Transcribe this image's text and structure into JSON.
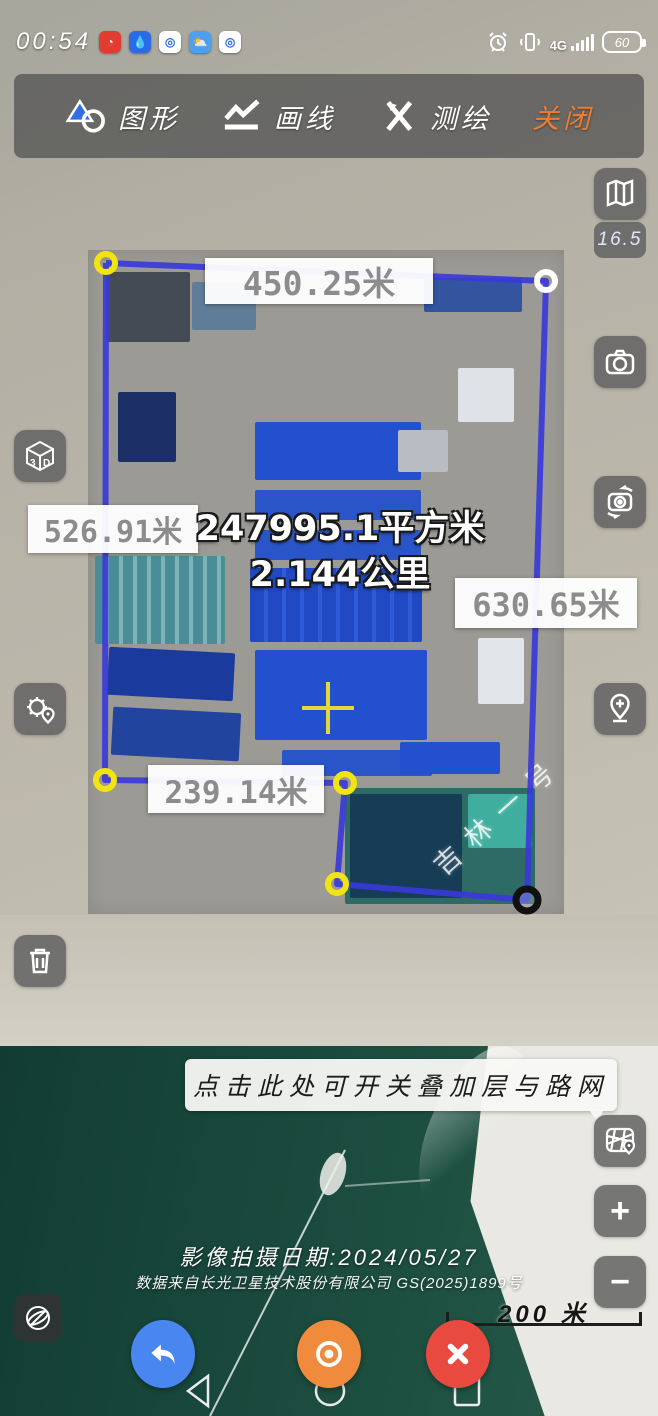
{
  "status_bar": {
    "time": "00:54",
    "network": "4G",
    "battery": "60",
    "app_icons": [
      "red-app-icon",
      "blue-drop-app-icon",
      "ring-app-icon",
      "weather-app-icon",
      "ring-app-icon-2"
    ],
    "system_icons": [
      "alarm-icon",
      "vibrate-icon",
      "signal-icon",
      "battery-icon"
    ]
  },
  "toolbar": {
    "items": [
      {
        "label": "图形",
        "icon": "shapes-icon"
      },
      {
        "label": "画线",
        "icon": "polyline-icon"
      },
      {
        "label": "测绘",
        "icon": "survey-icon"
      },
      {
        "label": "关闭",
        "icon": "none"
      }
    ],
    "close_color": "#ed7d31"
  },
  "map": {
    "zoom_level": "16.5",
    "watermark": "吉林一号",
    "provider": "吉林一号"
  },
  "measurements": {
    "top_edge": "450.25米",
    "left_edge": "526.91米",
    "right_edge": "630.65米",
    "bottom_edge": "239.14米",
    "area": "247995.1平方米",
    "perimeter": "2.144公里",
    "polygon_color": "#3a3ad8",
    "vertex_yellow": "#f2e412",
    "vertex_white": "#ffffff",
    "vertex_black": "#111111"
  },
  "side_buttons": {
    "right": [
      "map-book-icon",
      "camera-icon",
      "camera-switch-icon",
      "add-pin-icon",
      "road-layers-icon",
      "zoom-in-button",
      "zoom-out-button"
    ],
    "left": [
      "cube-3d-icon",
      "gear-pin-icon",
      "trash-icon"
    ]
  },
  "controls": {
    "zoom_in": "+",
    "zoom_out": "−"
  },
  "banner": {
    "text": "点击此处可开关叠加层与路网"
  },
  "attribution": {
    "date": "影像拍摄日期:2024/05/27",
    "source": "数据来自长光卫星技术股份有限公司 GS(2025)1899号"
  },
  "scale_bar": {
    "label": "200 米"
  },
  "bottom_actions": {
    "undo_color": "#4a86f0",
    "locate_color": "#f08b3e",
    "close_color": "#e84a40"
  }
}
